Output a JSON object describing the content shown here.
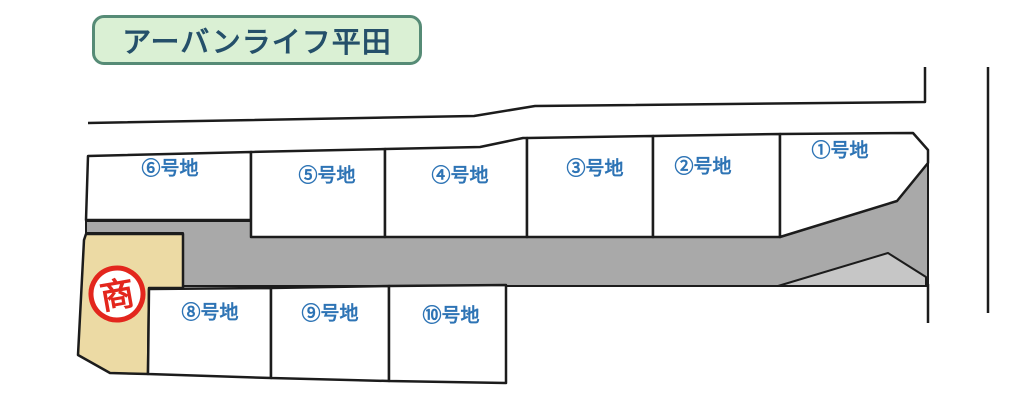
{
  "title": "アーバンライフ平田",
  "lots": [
    {
      "label": "①号地"
    },
    {
      "label": "②号地"
    },
    {
      "label": "③号地"
    },
    {
      "label": "④号地"
    },
    {
      "label": "⑤号地"
    },
    {
      "label": "⑥号地"
    },
    {
      "label": "⑧号地"
    },
    {
      "label": "⑨号地"
    },
    {
      "label": "⑩号地"
    }
  ],
  "stamp": {
    "text": "商"
  },
  "colors": {
    "road": "#a9a9a9",
    "road_light": "#c6c6c6",
    "corner_lot": "#ecdaa4",
    "lot_fill": "#ffffff",
    "label_blue": "#2e74b5",
    "stamp_red": "#e3261d",
    "outline": "#1c1c1c",
    "title_bg": "#daf0d4",
    "title_border": "#568b76",
    "title_text": "#25506a"
  }
}
